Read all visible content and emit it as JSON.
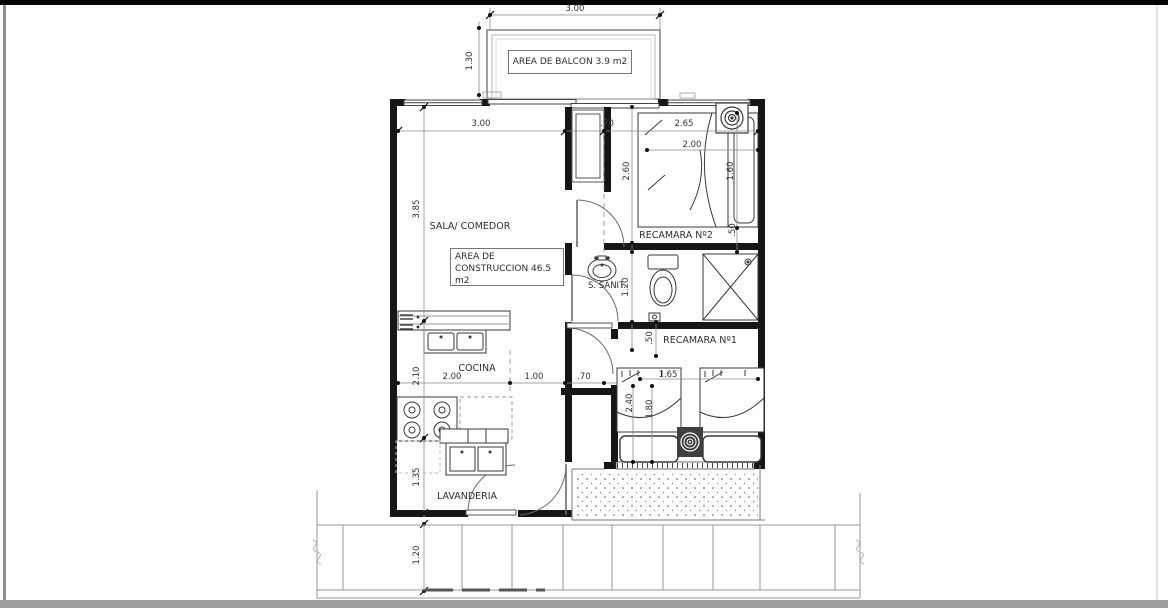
{
  "meta": {
    "drawing_type": "architectural floor plan"
  },
  "colors": {
    "ink": "#2f2f2f",
    "wall": "#161616",
    "dim_line": "#8a8a8a",
    "frame_top": "#000000",
    "frame_bottom": "#9e9e9e",
    "frame_left": "#8f8f8f"
  },
  "rooms": {
    "balcony": "AREA DE BALCON 3.9 m2",
    "living": "SALA/ COMEDOR",
    "construction_line1": "AREA DE",
    "construction_line2": "CONSTRUCCION 46.5 m2",
    "bedroom2": "RECAMARA Nº2",
    "bathroom": "S. SANIT.",
    "bedroom1": "RECAMARA Nº1",
    "kitchen": "COCINA",
    "laundry": "LAVANDERIA"
  },
  "dims": {
    "balcony_w": "3.00",
    "balcony_d": "1.30",
    "living_w": "3.00",
    "hall_w_top": ".70",
    "bed2_w": "2.65",
    "bed2_bed_w": "2.00",
    "living_d": "3.85",
    "bed2_d": "2.60",
    "bed2_bed_d": "1.60",
    "bed2_gap": ".50",
    "bath_d": "1.20",
    "bath_gap": ".50",
    "kitchen_d": "2.10",
    "kitchen_w": "2.00",
    "mid_w": "1.00",
    "hall_w_bottom": ".70",
    "bed1_w": "1.65",
    "bed1_d": "2.40",
    "bed1_bed_d": "1.80",
    "laundry_d": "1.35",
    "sidewalk_d": "1.20"
  }
}
